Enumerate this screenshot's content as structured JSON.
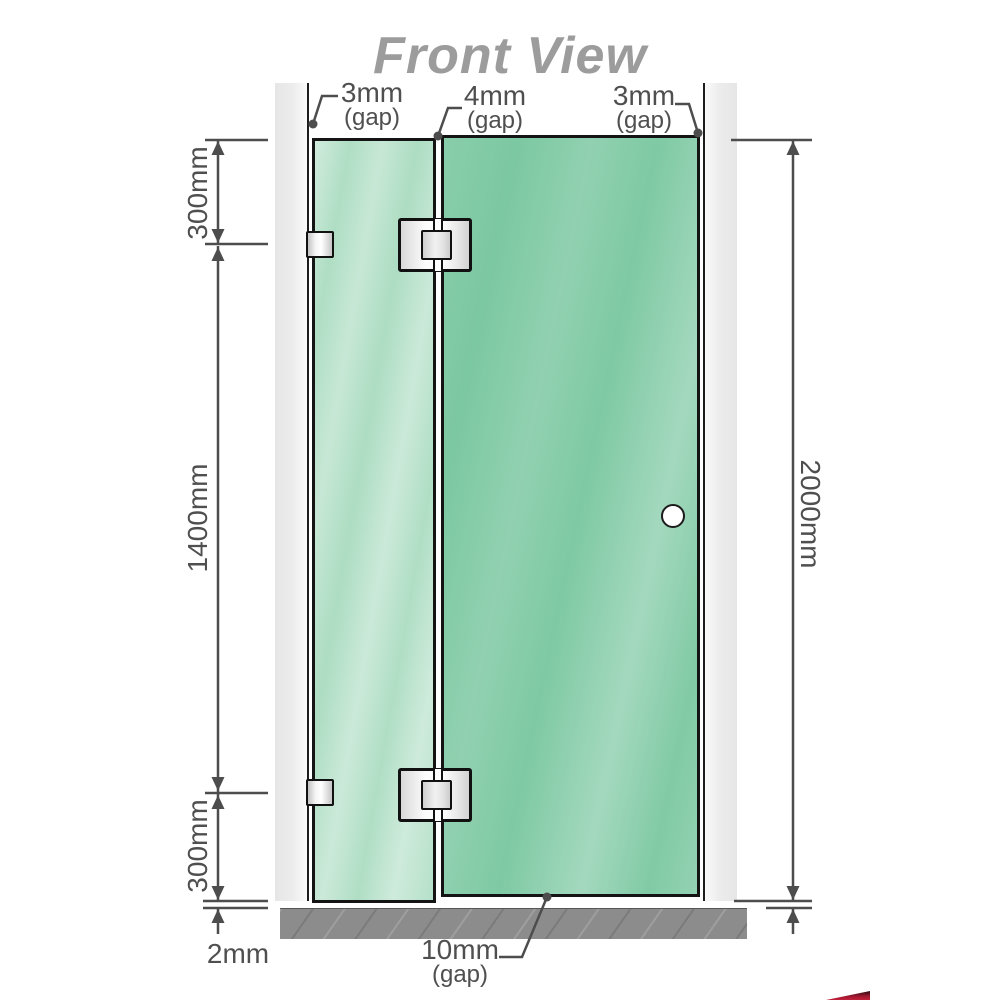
{
  "title": "Front View",
  "annotations": {
    "gap_left": {
      "value": "3mm",
      "note": "(gap)"
    },
    "gap_middle": {
      "value": "4mm",
      "note": "(gap)"
    },
    "gap_right": {
      "value": "3mm",
      "note": "(gap)"
    },
    "gap_bottom": {
      "value": "10mm",
      "note": "(gap)"
    }
  },
  "dimensions": {
    "left_top": "300mm",
    "left_middle": "1400mm",
    "left_bottom": "300mm",
    "right_full": "2000mm",
    "floor_gap": "2mm"
  },
  "colors": {
    "glass_fixed_panel": "#abdcc1",
    "glass_door_panel": "#7cc8a2",
    "wall": "#e9e9e9",
    "floor": "#8c8c8c",
    "dimension_lines": "#4d4d4d",
    "title_text": "#9c9c9c"
  }
}
